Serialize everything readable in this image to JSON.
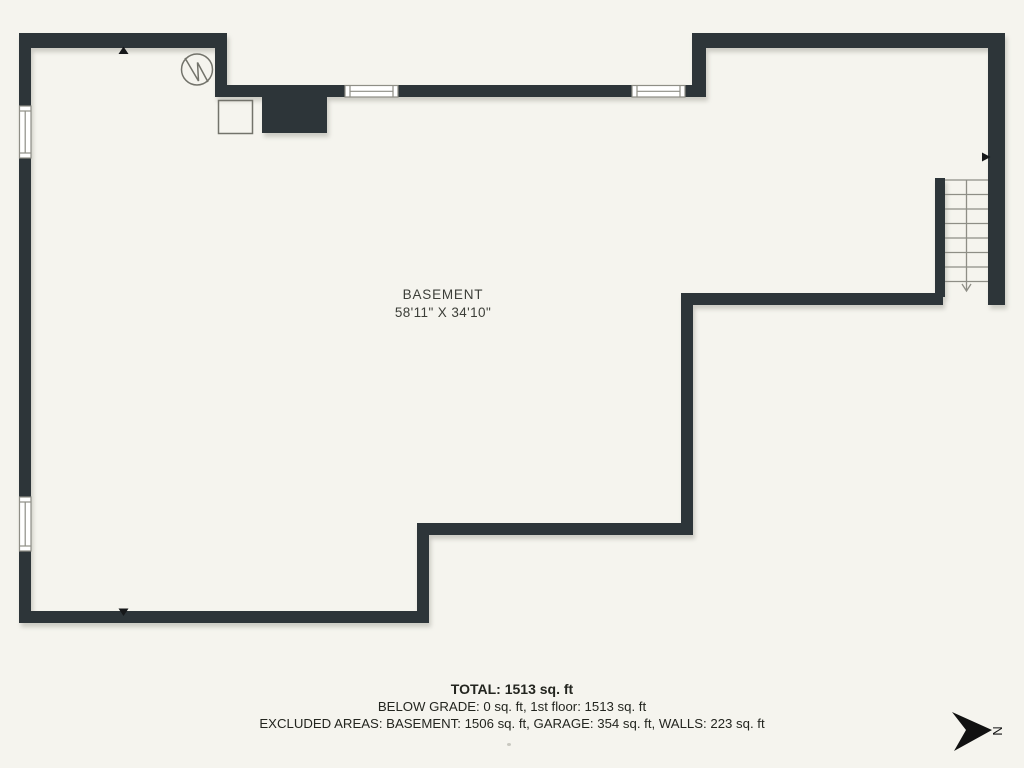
{
  "colors": {
    "background": "#f5f4ee",
    "wall": "#2d3539",
    "detail_line": "#8e8e86",
    "marker": "#16181a",
    "text_dark": "#23251f",
    "text_room": "#3c3e38"
  },
  "room": {
    "name": "BASEMENT",
    "dimensions": "58'11\" X 34'10\""
  },
  "summary": {
    "total": "TOTAL: 1513 sq. ft",
    "below_grade": "BELOW GRADE: 0 sq. ft, 1st floor: 1513 sq. ft",
    "excluded_areas": "EXCLUDED AREAS: BASEMENT: 1506 sq. ft, GARAGE: 354 sq. ft, WALLS: 223 sq. ft"
  },
  "compass": {
    "label": "N"
  }
}
